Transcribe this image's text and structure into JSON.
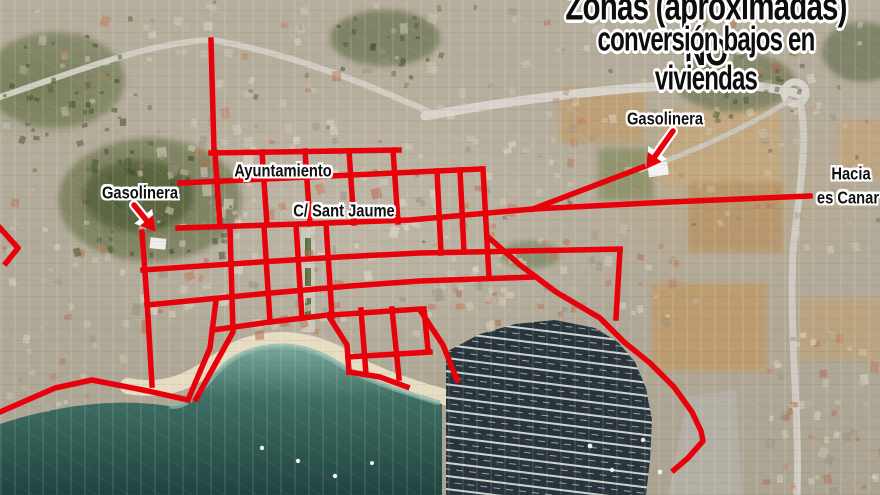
{
  "map": {
    "title": {
      "line1": "Zonas (aproximadas) NO",
      "line2": "conversión bajos en viviendas",
      "text_color": "#0d0d0d",
      "outline_color": "#ffffff"
    },
    "labels": [
      {
        "id": "label-gasolinera-west",
        "text": "Gasolinera",
        "x": 140,
        "y": 194,
        "size": 16
      },
      {
        "id": "label-ayuntamiento",
        "text": "Ayuntamiento",
        "x": 283,
        "y": 172,
        "size": 16
      },
      {
        "id": "label-carrer-sant-jaume",
        "text": "C/ Sant Jaume",
        "x": 344,
        "y": 212,
        "size": 16
      },
      {
        "id": "label-gasolinera-east",
        "text": "Gasolinera",
        "x": 665,
        "y": 120,
        "size": 16
      },
      {
        "id": "label-hacia",
        "text": "Hacia",
        "x": 851,
        "y": 175,
        "size": 16
      },
      {
        "id": "label-es-canar",
        "text": "es Canar",
        "x": 848,
        "y": 199,
        "size": 16
      }
    ],
    "overlay": {
      "color": "#e8000a",
      "line_width": 5.5,
      "zone_lines": [
        [
          [
            211,
            40
          ],
          [
            214,
            152
          ]
        ],
        [
          [
            211,
            153
          ],
          [
            399,
            150
          ]
        ],
        [
          [
            180,
            183
          ],
          [
            480,
            169
          ]
        ],
        [
          [
            178,
            228
          ],
          [
            300,
            224
          ],
          [
            410,
            220
          ],
          [
            533,
            209
          ],
          [
            670,
            202
          ],
          [
            810,
            196
          ]
        ],
        [
          [
            533,
            209
          ],
          [
            643,
            167
          ]
        ],
        [
          [
            143,
            270
          ],
          [
            260,
            262
          ],
          [
            340,
            257
          ],
          [
            420,
            253
          ],
          [
            620,
            249
          ]
        ],
        [
          [
            620,
            250
          ],
          [
            616,
            318
          ]
        ],
        [
          [
            147,
            305
          ],
          [
            260,
            294
          ],
          [
            350,
            286
          ],
          [
            420,
            281
          ],
          [
            535,
            277
          ]
        ],
        [
          [
            142,
            232
          ],
          [
            147,
            300
          ],
          [
            152,
            385
          ]
        ],
        [
          [
            0,
            412
          ],
          [
            55,
            388
          ],
          [
            92,
            380
          ],
          [
            148,
            391
          ],
          [
            188,
            400
          ]
        ],
        [
          [
            188,
            400
          ],
          [
            210,
            348
          ],
          [
            216,
            300
          ]
        ],
        [
          [
            196,
            399
          ],
          [
            233,
            332
          ],
          [
            230,
            228
          ]
        ],
        [
          [
            213,
            330
          ],
          [
            270,
            322
          ],
          [
            328,
            315
          ]
        ],
        [
          [
            264,
            226
          ],
          [
            270,
            322
          ]
        ],
        [
          [
            296,
            225
          ],
          [
            302,
            318
          ]
        ],
        [
          [
            326,
            224
          ],
          [
            332,
            316
          ]
        ],
        [
          [
            328,
            315
          ],
          [
            347,
            345
          ],
          [
            349,
            372
          ]
        ],
        [
          [
            349,
            372
          ],
          [
            380,
            377
          ],
          [
            407,
            387
          ]
        ],
        [
          [
            420,
            310
          ],
          [
            443,
            345
          ],
          [
            457,
            380
          ]
        ],
        [
          [
            488,
            237
          ],
          [
            520,
            265
          ],
          [
            556,
            292
          ],
          [
            600,
            318
          ],
          [
            624,
            342
          ],
          [
            650,
            363
          ],
          [
            674,
            387
          ],
          [
            692,
            412
          ],
          [
            701,
            431
          ],
          [
            703,
            441
          ],
          [
            688,
            458
          ],
          [
            674,
            470
          ]
        ],
        [
          [
            215,
            152
          ],
          [
            220,
            226
          ]
        ],
        [
          [
            262,
            152
          ],
          [
            267,
            225
          ]
        ],
        [
          [
            305,
            151
          ],
          [
            310,
            224
          ]
        ],
        [
          [
            349,
            151
          ],
          [
            354,
            223
          ]
        ],
        [
          [
            393,
            150
          ],
          [
            398,
            222
          ]
        ],
        [
          [
            437,
            171
          ],
          [
            441,
            253
          ]
        ],
        [
          [
            460,
            170
          ],
          [
            464,
            252
          ]
        ],
        [
          [
            483,
            169
          ],
          [
            489,
            277
          ]
        ],
        [
          [
            332,
            315
          ],
          [
            420,
            309
          ]
        ],
        [
          [
            348,
            357
          ],
          [
            430,
            352
          ]
        ],
        [
          [
            361,
            310
          ],
          [
            366,
            374
          ]
        ],
        [
          [
            392,
            309
          ],
          [
            399,
            378
          ]
        ],
        [
          [
            424,
            309
          ],
          [
            428,
            350
          ]
        ],
        [
          [
            0,
            228
          ],
          [
            18,
            248
          ],
          [
            6,
            263
          ]
        ]
      ],
      "arrows": [
        {
          "id": "arrow-to-gasolinera-west",
          "x1": 134,
          "y1": 205,
          "x2": 156,
          "y2": 232
        },
        {
          "id": "arrow-to-gasolinera-east",
          "x1": 673,
          "y1": 131,
          "x2": 646,
          "y2": 169
        }
      ]
    }
  }
}
